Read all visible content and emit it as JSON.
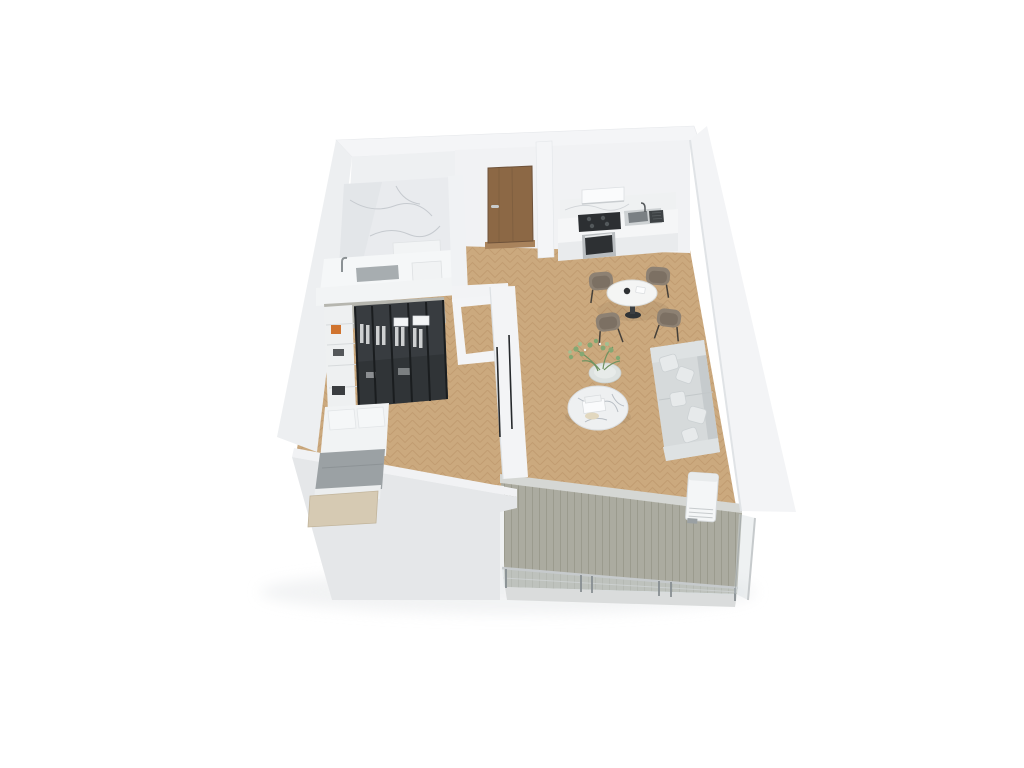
{
  "scene": {
    "title": "3D apartment floor plan render",
    "background": "#ffffff",
    "rooms": [
      {
        "label": "Bathroom"
      },
      {
        "label": "Entry hall"
      },
      {
        "label": "Kitchen"
      },
      {
        "label": "Dining area"
      },
      {
        "label": "Living area"
      },
      {
        "label": "Bedroom"
      },
      {
        "label": "Balcony"
      }
    ],
    "furniture": {
      "bathroom": [
        "bathtub with chrome faucet",
        "shower bench",
        "washbasin",
        "marble wall",
        "gray tile floor"
      ],
      "entry": [
        "wood front door with lever handle"
      ],
      "kitchen": [
        "range hood",
        "black cooktop",
        "sink with faucet",
        "drying rack",
        "built-in oven",
        "white counter"
      ],
      "dining": [
        "round white pedestal table",
        "four taupe upholstered chairs",
        "dark teapot",
        "white cup"
      ],
      "living": [
        "light gray three-seat sofa",
        "five cushions",
        "round marble coffee table",
        "white books",
        "beige tray",
        "round side table",
        "green plant"
      ],
      "bedroom": [
        "glass-front wardrobe with black mullions",
        "hanging white clothes",
        "folded linens",
        "orange storage box",
        "double bed with beige headboard",
        "gray blanket",
        "white pillows",
        "sliding pocket door"
      ],
      "balcony": [
        "gray-green wood decking",
        "glass railing with metal posts",
        "air-conditioner unit",
        "threshold strip"
      ]
    },
    "palette": {
      "wall": "#eff1f3",
      "wall_shadow": "#e4e6e9",
      "wood_floor": "#cba97e",
      "wood_floor_line": "#b89063",
      "bath_floor": "#b7babc",
      "marble": "#e9ebee",
      "door": "#8c6845",
      "door_threshold": "#a9835c",
      "cooktop": "#2c2f32",
      "oven_glass": "#2d3033",
      "sink_basin": "#7a8084",
      "chair": "#8d8173",
      "chair_inner": "#7c7063",
      "table_top": "#f4f5f4",
      "sofa": "#d6dadb",
      "cushion": "#e7eaeb",
      "coffee_table": "#eef0f1",
      "plant": "#84a873",
      "wardrobe_glass": "#383c40",
      "wardrobe_top": "#b6b6af",
      "accent_orange": "#d0742f",
      "blanket": "#9ba1a4",
      "headboard": "#d6cab3",
      "deck": "#ababa0",
      "deck_line": "#9b9b8e",
      "rail_metal": "#878e92",
      "glass_tint": "rgba(213,221,223,0.45)"
    }
  }
}
